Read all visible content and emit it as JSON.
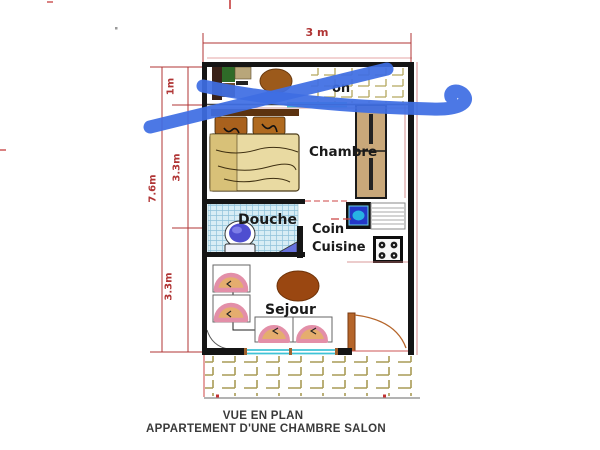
{
  "drawing": {
    "caption_line1": "VUE EN PLAN",
    "caption_line2": "APPARTEMENT D'UNE CHAMBRE SALON"
  },
  "dimensions": {
    "width_top": "3 m",
    "height_total": "7.6m",
    "balcony_depth": "1m",
    "chambre_height": "3.3m",
    "sejour_height": "3.3m"
  },
  "rooms": {
    "balcony_label_partial": "on",
    "bedroom": "Chambre",
    "shower": "Douche",
    "kitchen_line1": "Coin",
    "kitchen_line2": "Cuisine",
    "living": "Sejour"
  },
  "annotation": {
    "type": "blue-x-scribble",
    "color": "#3E6EE3"
  },
  "palette": {
    "dimension_red": "#B03434",
    "wall_black": "#151515",
    "window_cyan": "#3FC3D6",
    "tile_tan": "#A89B55",
    "door_brown": "#B5652A",
    "label_black": "#1A1A1A",
    "caption_gray": "#3A3A3A"
  }
}
